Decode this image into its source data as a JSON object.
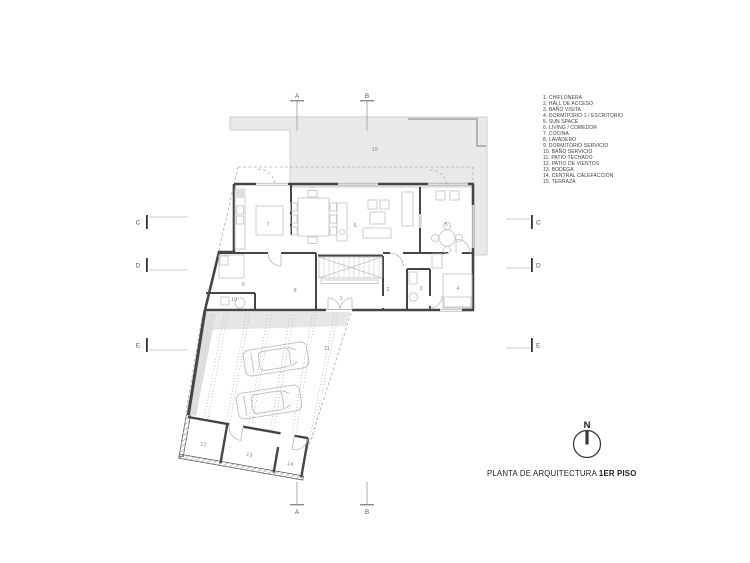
{
  "legend": {
    "items": [
      "1. CHIFLONERA",
      "2. HALL DE ACCESO",
      "3. BAÑO VISITA",
      "4. DORMITORIO 1 / ESCRITORIO",
      "5. SUN SPACE",
      "6. LIVING / COMEDOR",
      "7. COCINA",
      "8. LAVADERO",
      "9. DORMITORIO SERVICIO",
      "10. BAÑO SERVICIO",
      "11. PATIO TECHADO",
      "12. PATIO DE VIENTOS",
      "13. BODEGA",
      "14. CENTRAL CALEFACCIÓN",
      "15. TERRAZA"
    ]
  },
  "title": {
    "prefix": "PLANTA DE ARQUITECTURA ",
    "bold": "1ER PISO"
  },
  "north": {
    "label": "N"
  },
  "grid": {
    "top": [
      "A",
      "B"
    ],
    "bottom": [
      "A",
      "B"
    ],
    "left": [
      "C",
      "D",
      "E"
    ],
    "right": [
      "C",
      "D",
      "E"
    ]
  },
  "plan": {
    "room_numbers": [
      "1",
      "2",
      "3",
      "4",
      "5",
      "6",
      "7",
      "8",
      "9",
      "10",
      "11",
      "12",
      "13",
      "14",
      "15"
    ]
  },
  "colors": {
    "wall": "#454545",
    "terrace_fill": "#e9e9e9",
    "furniture_line": "#c2c2c2",
    "dash_line": "#ababab"
  }
}
